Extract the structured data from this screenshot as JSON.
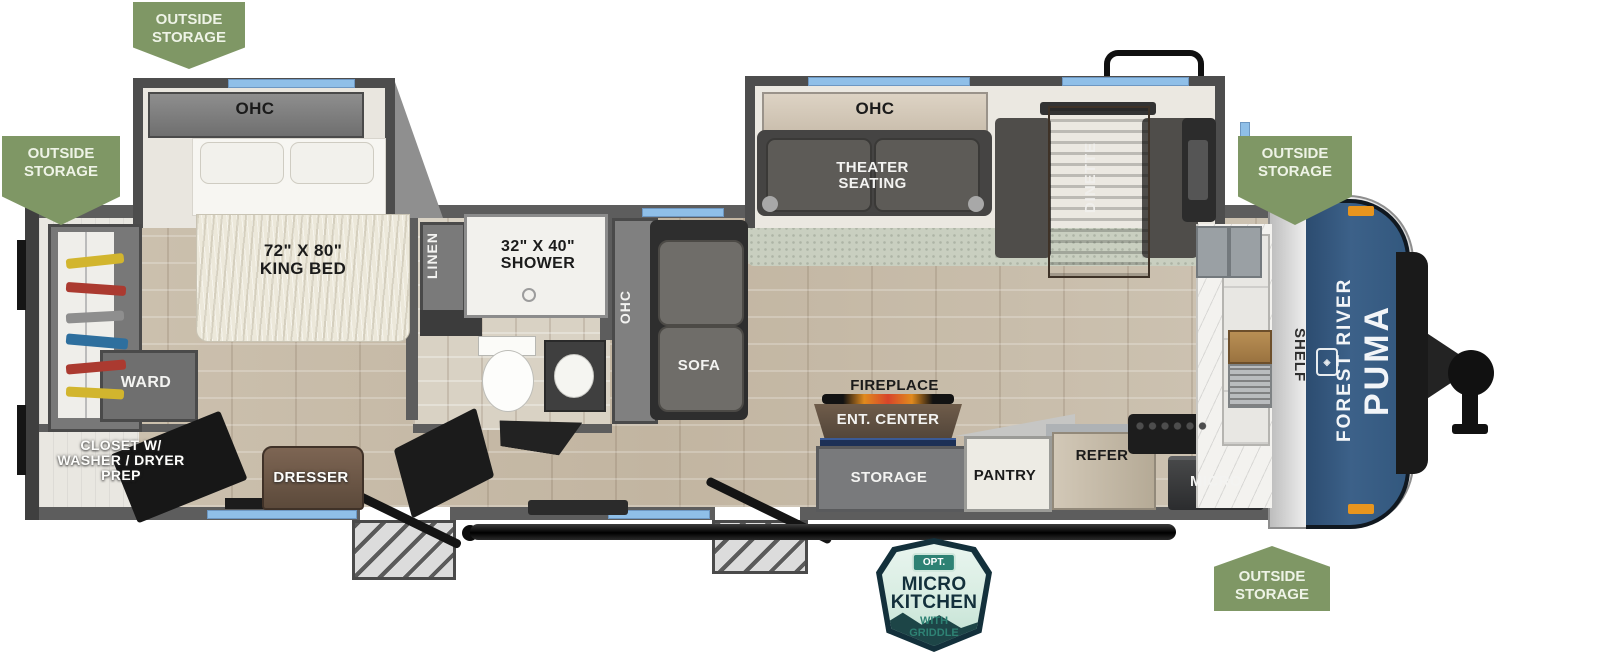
{
  "title": "Forest River Puma travel trailer floor plan",
  "colors": {
    "badge_green": "#7f9765",
    "cap_blue": "#3c6189",
    "window_blue": "#8fbfe8",
    "badge_teal": "#2e8274",
    "badge_navy": "#13303b"
  },
  "badges": {
    "top_left": "OUTSIDE\nSTORAGE",
    "rear": "OUTSIDE\nSTORAGE",
    "front": "OUTSIDE\nSTORAGE",
    "bottom": "OUTSIDE\nSTORAGE"
  },
  "option_badge": {
    "opt": "OPT.",
    "title": "MICRO\nKITCHEN",
    "subtitle": "WITH\nGRIDDLE"
  },
  "front_cap": {
    "brand_name": "FOREST RIVER",
    "model_name": "PUMA",
    "shelf_label": "SHELF"
  },
  "bedroom": {
    "ohc": "OHC",
    "king_bed": "72\" X 80\"\nKING BED",
    "dresser": "DRESSER",
    "ward": "WARD",
    "closet": "CLOSET W/\nWASHER / DRYER\nPREP"
  },
  "bathroom": {
    "linen": "LINEN",
    "shower": "32\" X 40\"\nSHOWER"
  },
  "living": {
    "sofa_ohc": "OHC",
    "sofa": "SOFA",
    "theater_ohc": "OHC",
    "theater_seating": "THEATER\nSEATING",
    "dinette": "DINETTE"
  },
  "kitchen": {
    "fireplace": "FIREPLACE",
    "ent_center": "ENT. CENTER",
    "storage": "STORAGE",
    "pantry": "PANTRY",
    "refer": "REFER",
    "micro": "MICRO"
  }
}
